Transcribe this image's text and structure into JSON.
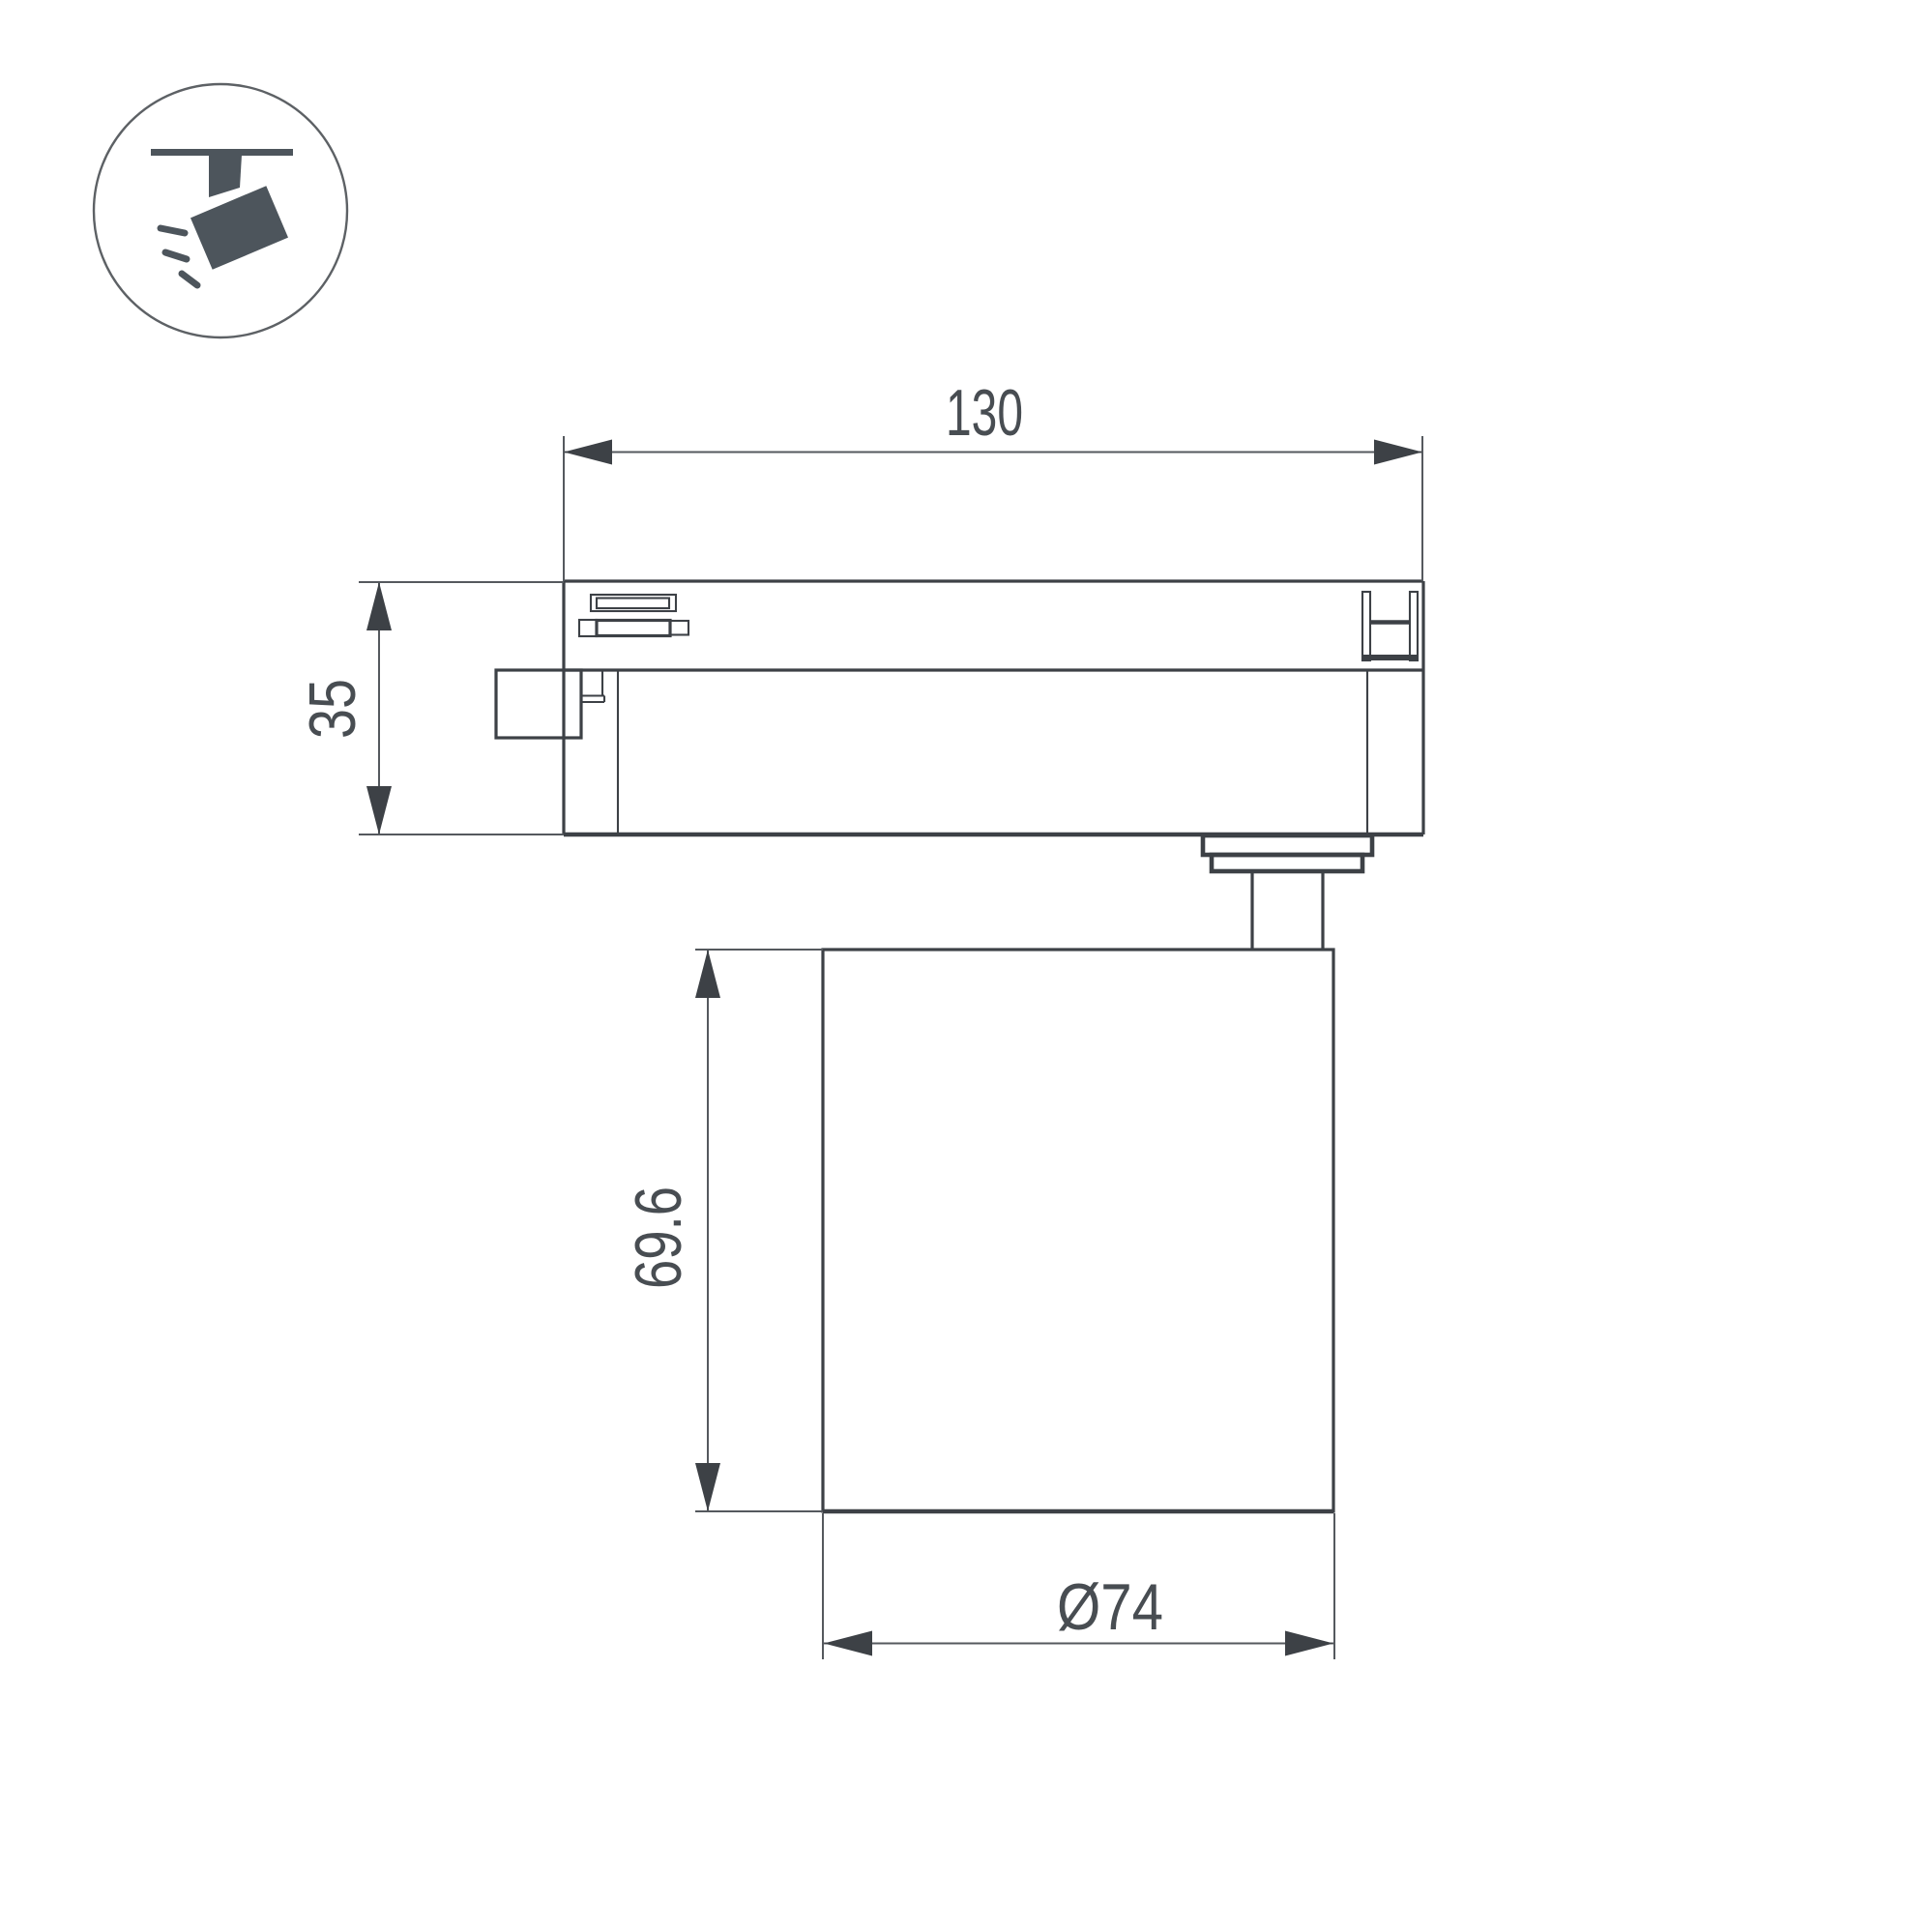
{
  "icon": {
    "label": "track-spotlight"
  },
  "dimensions": {
    "track_width": "130",
    "adapter_height": "35",
    "head_height": "69.6",
    "head_diameter": "Ø74"
  },
  "colors": {
    "background": "#ffffff",
    "outline": "#3d4146",
    "dimension": "#55595e",
    "text": "#484d52",
    "icon": "#4d555c",
    "icon_ring": "#5d6165"
  }
}
